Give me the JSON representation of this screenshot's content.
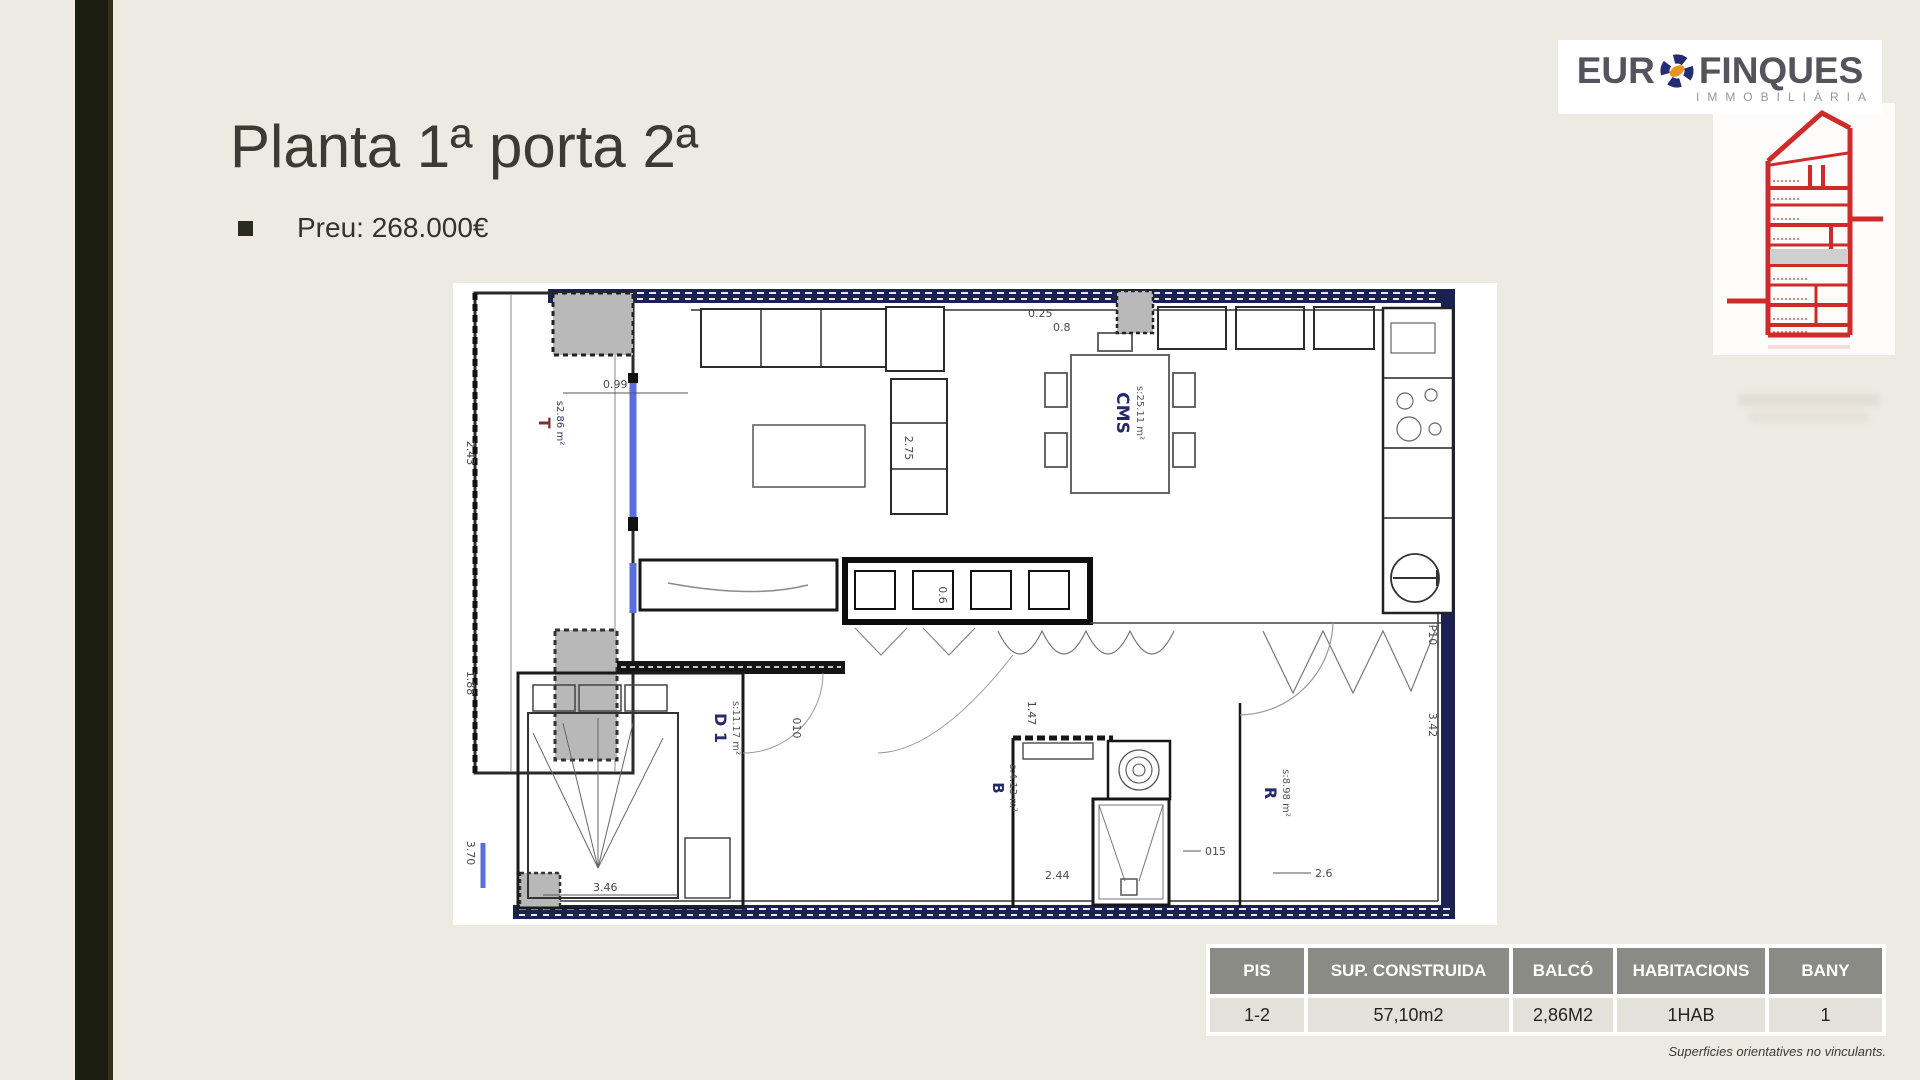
{
  "header": {
    "title": "Planta 1ª porta 2ª",
    "price": "Preu: 268.000€"
  },
  "logo": {
    "eur": "EUR",
    "finques": "FINQUES",
    "subtitle": "IMMOBILIÀRIA",
    "brand_navy": "#232d73",
    "brand_orange": "#e79421",
    "sketch_red": "#cf2b2a"
  },
  "floorplan": {
    "rooms": [
      {
        "code": "T",
        "area": "s2.86 m²"
      },
      {
        "code": "CMS",
        "area": "s:25.11 m²"
      },
      {
        "code": "D 1",
        "area": "s:11.17 m²"
      },
      {
        "code": "B",
        "area": "s:4.13 m²"
      },
      {
        "code": "R",
        "area": "s:8.98 m²"
      }
    ],
    "dimensions": [
      "0.99",
      "2.43",
      "1.88",
      "3.70",
      "0.25",
      "0.8",
      "2.75",
      "0.6",
      "3.46",
      "010",
      "1.47",
      "2.44",
      "015",
      "2.6",
      "P10",
      "3.42"
    ],
    "glass_blue": "#5b6ee1",
    "wall_navy": "#1c2153"
  },
  "table": {
    "headers": [
      "PIS",
      "SUP. CONSTRUIDA",
      "BALCÓ",
      "HABITACIONS",
      "BANY"
    ],
    "row": [
      "1-2",
      "57,10m2",
      "2,86M2",
      "1HAB",
      "1"
    ],
    "footnote": "Superficies orientatives no vinculants."
  }
}
